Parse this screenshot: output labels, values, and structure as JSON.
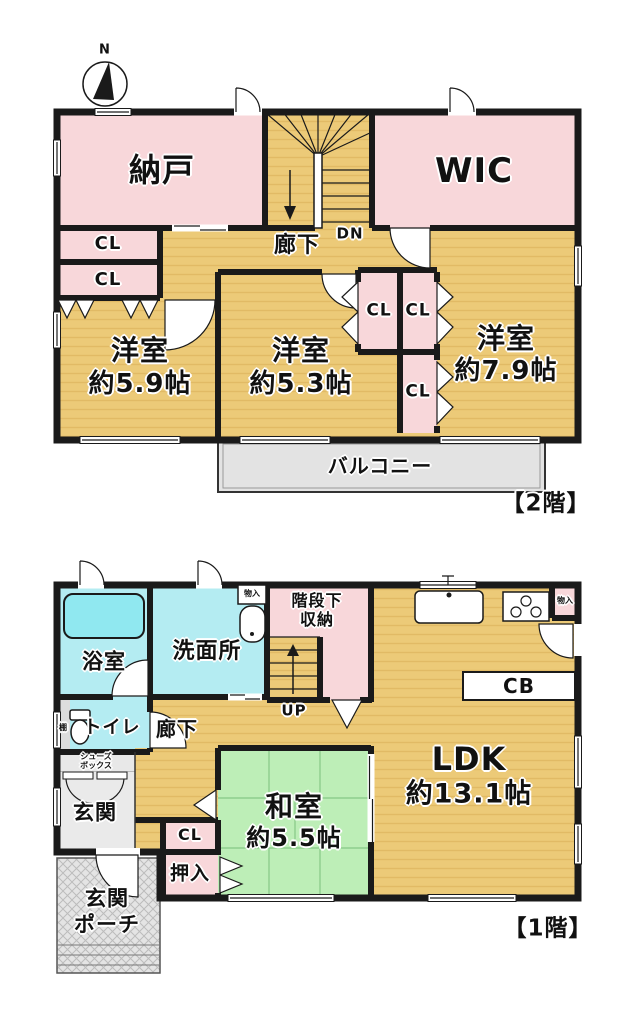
{
  "palette": {
    "wall": "#1a1a1a",
    "wood_floor": "#ecca78",
    "wood_stripe": "#d9ad55",
    "pink_room": "#f8d7da",
    "cyan_room": "#b4ecf2",
    "tatami_green": "#bdeeb7",
    "balcony_gray": "#e3e3e3",
    "tub_cyan": "#90e8f0"
  },
  "compass": {
    "north": "N"
  },
  "shared": {
    "cl": "CL",
    "corridor": "廊下",
    "storage": "物入",
    "western_room": "洋室"
  },
  "floor2": {
    "caption": "【2階】",
    "storage_room": "納戸",
    "walk_in_closet": "WIC",
    "down": "DN",
    "size_59": "約5.9帖",
    "size_53": "約5.3帖",
    "size_79": "約7.9帖",
    "balcony": "バルコニー"
  },
  "floor1": {
    "caption": "【1階】",
    "bath": "浴室",
    "washroom": "洗面所",
    "under_stairs_1": "階段下",
    "under_stairs_2": "収納",
    "up": "UP",
    "toilet": "トイレ",
    "shelf": "棚",
    "shoes_1": "シューズ",
    "shoes_2": "ボックス",
    "entrance": "玄関",
    "oshiire": "押入",
    "japanese_room": "和室",
    "size_55": "約5.5帖",
    "ldk": "LDK",
    "size_131": "約13.1帖",
    "cupboard": "CB",
    "porch_1": "玄関",
    "porch_2": "ポーチ"
  }
}
